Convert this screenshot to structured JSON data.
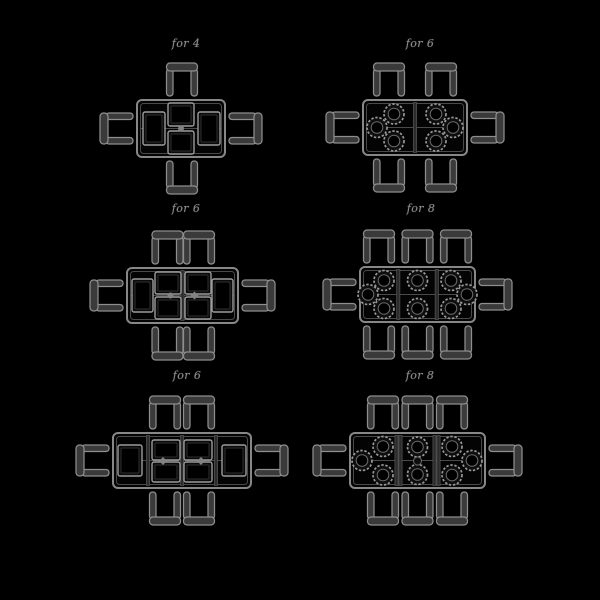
{
  "style": {
    "background": "#000000",
    "line_color": "#878787",
    "chair_fill": "#3a3a3a",
    "chair_stroke": "#8e8e8e",
    "table_fill": "#040404",
    "table_inner_line": "#4a4a4a",
    "seam_fill": "#2c2c2c",
    "seam_stroke": "#5e5e5e",
    "mat_stroke": "#9c9c9c",
    "mat_fill": "#0b0b0b",
    "mat_inner": "#2f2f2f",
    "plate_stroke": "#989898",
    "plate_fill": "#0e0e0e",
    "plate_inner_stroke": "#6a6a6a",
    "item_fill": "#828282",
    "caption_color": "#8f8f8f"
  },
  "panels": [
    {
      "caption": "for 4",
      "caption_x": 186,
      "caption_y": 37,
      "table": {
        "x": 137,
        "y": 100,
        "w": 88,
        "h": 57
      },
      "dividers": [],
      "center_line": true,
      "chairs": {
        "top": [
          182
        ],
        "bottom": [
          182
        ],
        "left": [
          128.5
        ],
        "right": [
          128.5
        ]
      },
      "mats": [
        {
          "x": 143,
          "y": 112,
          "w": 22,
          "h": 33
        },
        {
          "x": 198,
          "y": 112,
          "w": 22,
          "h": 33
        },
        {
          "x": 168,
          "y": 103,
          "w": 26,
          "h": 23
        },
        {
          "x": 168,
          "y": 131,
          "w": 26,
          "h": 23
        }
      ],
      "plates": [],
      "items": [
        {
          "type": "circle",
          "x": 181,
          "y": 128.5
        }
      ]
    },
    {
      "caption": "for 6",
      "caption_x": 420,
      "caption_y": 37,
      "table": {
        "x": 363,
        "y": 100,
        "w": 104,
        "h": 55
      },
      "dividers": [
        415
      ],
      "center_line": true,
      "chairs": {
        "top": [
          389,
          441
        ],
        "bottom": [
          389,
          441
        ],
        "left": [
          127.5
        ],
        "right": [
          127.5
        ]
      },
      "mats": [],
      "plates": [
        {
          "x": 394,
          "y": 114
        },
        {
          "x": 377,
          "y": 127.5
        },
        {
          "x": 394,
          "y": 141
        },
        {
          "x": 436,
          "y": 114
        },
        {
          "x": 453,
          "y": 127.5
        },
        {
          "x": 436,
          "y": 141
        }
      ],
      "items": []
    },
    {
      "caption": "for 6",
      "caption_x": 186,
      "caption_y": 202,
      "table": {
        "x": 127,
        "y": 268,
        "w": 111,
        "h": 55
      },
      "dividers": [
        182.5
      ],
      "center_line": true,
      "chairs": {
        "top": [
          167.5,
          199
        ],
        "bottom": [
          167.5,
          199
        ],
        "left": [
          295.5
        ],
        "right": [
          295.5
        ]
      },
      "mats": [
        {
          "x": 132,
          "y": 279,
          "w": 21,
          "h": 33
        },
        {
          "x": 212,
          "y": 279,
          "w": 21,
          "h": 33
        },
        {
          "x": 155,
          "y": 272,
          "w": 26,
          "h": 22
        },
        {
          "x": 185,
          "y": 272,
          "w": 26,
          "h": 22
        },
        {
          "x": 155,
          "y": 297,
          "w": 26,
          "h": 22
        },
        {
          "x": 185,
          "y": 297,
          "w": 26,
          "h": 22
        }
      ],
      "plates": [],
      "items": [
        {
          "type": "circle",
          "x": 170.5,
          "y": 295.5
        },
        {
          "type": "diamond",
          "x": 194.5,
          "y": 295.5
        }
      ]
    },
    {
      "caption": "for 8",
      "caption_x": 421,
      "caption_y": 202,
      "table": {
        "x": 360,
        "y": 267,
        "w": 115,
        "h": 55
      },
      "dividers": [
        398.3,
        436.7
      ],
      "center_line": true,
      "chairs": {
        "top": [
          379,
          417.5,
          456
        ],
        "bottom": [
          379,
          417.5,
          456
        ],
        "left": [
          294.5
        ],
        "right": [
          294.5
        ]
      },
      "mats": [],
      "plates": [
        {
          "x": 384,
          "y": 280.5
        },
        {
          "x": 368,
          "y": 294.5
        },
        {
          "x": 384,
          "y": 308.5
        },
        {
          "x": 417.5,
          "y": 280.5
        },
        {
          "x": 417.5,
          "y": 308.5
        },
        {
          "x": 451,
          "y": 280.5
        },
        {
          "x": 467,
          "y": 294.5
        },
        {
          "x": 451,
          "y": 308.5
        }
      ],
      "items": []
    },
    {
      "caption": "for 6",
      "caption_x": 187,
      "caption_y": 369,
      "table": {
        "x": 113,
        "y": 433,
        "w": 138,
        "h": 55
      },
      "dividers": [
        148,
        182,
        216
      ],
      "center_line": true,
      "chairs": {
        "top": [
          165,
          199
        ],
        "bottom": [
          165,
          199
        ],
        "left": [
          460.5
        ],
        "right": [
          460.5
        ]
      },
      "mats": [
        {
          "x": 118,
          "y": 445,
          "w": 24,
          "h": 31
        },
        {
          "x": 222,
          "y": 445,
          "w": 24,
          "h": 31
        },
        {
          "x": 152,
          "y": 440,
          "w": 28,
          "h": 20
        },
        {
          "x": 184,
          "y": 440,
          "w": 28,
          "h": 20
        },
        {
          "x": 152,
          "y": 462,
          "w": 28,
          "h": 20
        },
        {
          "x": 184,
          "y": 462,
          "w": 28,
          "h": 20
        }
      ],
      "plates": [],
      "items": [
        {
          "type": "diamond",
          "x": 163,
          "y": 461
        },
        {
          "type": "diamond",
          "x": 201,
          "y": 461
        }
      ]
    },
    {
      "caption": "for 8",
      "caption_x": 420,
      "caption_y": 369,
      "table": {
        "x": 350,
        "y": 433,
        "w": 135,
        "h": 55
      },
      "dividers": [
        396.5,
        400.5,
        434.5,
        438.5
      ],
      "center_line": true,
      "chairs": {
        "top": [
          383,
          417.5,
          452
        ],
        "bottom": [
          383,
          417.5,
          452
        ],
        "left": [
          460.5
        ],
        "right": [
          460.5
        ]
      },
      "mats": [],
      "plates": [
        {
          "x": 383,
          "y": 446.5
        },
        {
          "x": 362,
          "y": 460.5
        },
        {
          "x": 383,
          "y": 475
        },
        {
          "x": 417.5,
          "y": 447
        },
        {
          "x": 417.5,
          "y": 474.5
        },
        {
          "x": 452,
          "y": 446.5
        },
        {
          "x": 472,
          "y": 460.5
        },
        {
          "x": 452,
          "y": 475
        }
      ],
      "items": [
        {
          "type": "dish",
          "x": 417.5,
          "y": 461
        }
      ]
    }
  ]
}
